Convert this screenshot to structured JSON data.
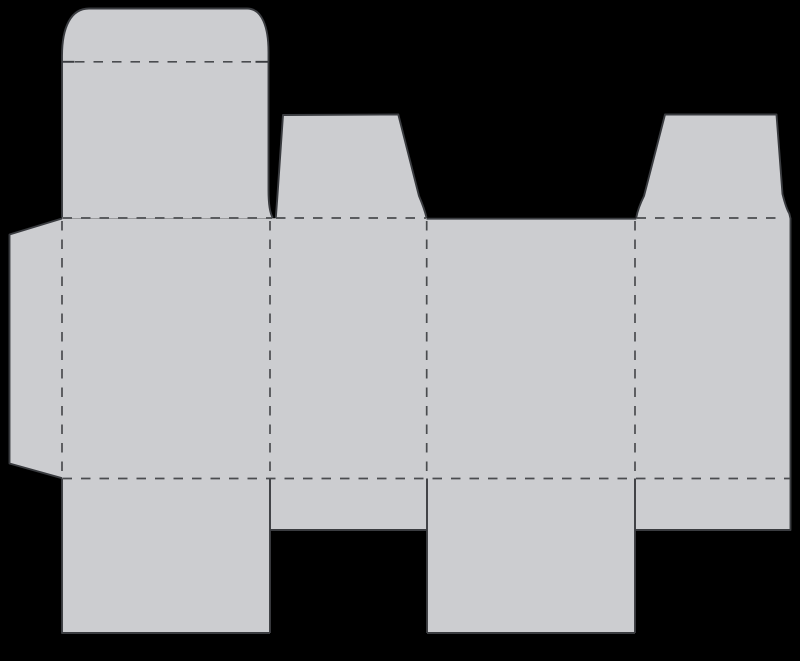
{
  "canvas": {
    "width": 800,
    "height": 661,
    "background": "#000000"
  },
  "dieline": {
    "description": "tuck-end carton box dieline blank",
    "fill_color": "#cccdd0",
    "cut_color": "#3a3c40",
    "fold_color": "#4a4c4f",
    "cut_width": 1.9,
    "fold_width": 1.7,
    "fold_dash": "9.5 9",
    "fills": [
      {
        "name": "glue-flap",
        "d": "M 62 218.5 L 9.5 234.5 L 9.5 463.5 L 62 478.2 Z"
      },
      {
        "name": "tuck-flap-and-lid-panel",
        "d": "M 62 218 L 62 56 C 62 27 71 8.5 89 8.5 L 247 8.5 C 262 8.5 268.5 27 268.5 52 L 268.5 190 Q 268.5 211 272.8 218 Z"
      },
      {
        "name": "dust-flap-top-left",
        "d": "M 275.8 218.5 L 277.2 199 L 283 115 L 398.3 114.5 L 419 196 Q 424.5 209 426.5 218.5 Z"
      },
      {
        "name": "dust-flap-top-right",
        "d": "M 636.3 218.5 Q 638 208 644 196 L 665 114.5 L 776.5 114.5 L 782.5 194 Q 786 208 790.5 218.5 Z"
      },
      {
        "name": "main-panel-strip",
        "d": "M 62 218.2 L 790.5 218.2 L 790.5 478.5 L 62 478.5 Z"
      },
      {
        "name": "bottom-flap-front",
        "d": "M 62 478.5 L 270 478.5 L 270 633 L 62 633 Z"
      },
      {
        "name": "bottom-flap-side-left",
        "d": "M 270 478.5 L 427 478.5 L 427 530 L 270 530 Z"
      },
      {
        "name": "bottom-flap-back",
        "d": "M 427 478.5 L 635 478.5 L 635 633 L 427 633 Z"
      },
      {
        "name": "bottom-flap-side-right",
        "d": "M 635 478.5 L 790.5 478.5 L 790.5 530 L 635 530 Z"
      }
    ],
    "cut_lines": [
      {
        "name": "glue-flap-cut",
        "d": "M 62 218.5 L 9.5 234.5 L 9.5 463.5 L 62 478.2"
      },
      {
        "name": "tuck-and-lid-cut",
        "d": "M 62 217.5 L 62 56 C 62 27 71 8.5 89 8.5 L 247 8.5 C 262 8.5 268.5 27 268.5 52 L 268.5 190 Q 268.5 211 272.8 217.8"
      },
      {
        "name": "tuck-notch-left-cut",
        "d": "M 62 61.8 L 74.5 61.8"
      },
      {
        "name": "tuck-notch-right-cut",
        "d": "M 255.5 61.8 L 268.5 61.8"
      },
      {
        "name": "dust-flap-left-cut",
        "d": "M 275.8 218 L 277.2 199 L 283 115 L 398.3 114.5 L 419 196 Q 424.5 209 426.5 217.5"
      },
      {
        "name": "strip-top-edge-cut",
        "d": "M 426.5 218.7 L 636.3 218.7"
      },
      {
        "name": "dust-flap-right-cut",
        "d": "M 636.3 217.5 Q 638 208 644 196 L 665 114.5 L 776.5 114.5 L 782.5 194 Q 786 208 789.3 213.5 L 790.5 218.5"
      },
      {
        "name": "right-edge-and-flap-cut",
        "d": "M 790.5 218 L 790.5 530 L 635 530"
      },
      {
        "name": "bottom-flap-divider-right-cut",
        "d": "M 635 478.5 L 635 633"
      },
      {
        "name": "bottom-flap-back-edge-cut",
        "d": "M 635 633 L 427 633"
      },
      {
        "name": "bottom-flap-divider-middle-cut",
        "d": "M 427 478.5 L 427 633"
      },
      {
        "name": "bottom-flap-side-left-edge-cut",
        "d": "M 427 530 L 270 530"
      },
      {
        "name": "bottom-flap-divider-left-cut",
        "d": "M 270 478.5 L 270 633"
      },
      {
        "name": "bottom-flap-front-edge-cut",
        "d": "M 270 633 L 62 633 L 62 478.5"
      }
    ],
    "fold_lines": [
      {
        "name": "tuck-flap-fold",
        "d": "M 75 61.8 L 255 61.8"
      },
      {
        "name": "top-fold-under-lid",
        "d": "M 62.5 218 L 272 218"
      },
      {
        "name": "top-fold-under-dust-flap-left",
        "d": "M 276 218 L 426 218"
      },
      {
        "name": "top-fold-under-dust-flap-right",
        "d": "M 636.5 218 L 776 218"
      },
      {
        "name": "bottom-fold",
        "d": "M 62.5 478.5 L 790 478.5"
      },
      {
        "name": "fold-glue-flap-front",
        "d": "M 62 221 L 62 478"
      },
      {
        "name": "fold-front-side-left",
        "d": "M 270 221 L 270 478"
      },
      {
        "name": "fold-side-left-back",
        "d": "M 426.7 221 L 426.7 478"
      },
      {
        "name": "fold-back-side-right",
        "d": "M 635 221 L 635 478"
      }
    ]
  }
}
